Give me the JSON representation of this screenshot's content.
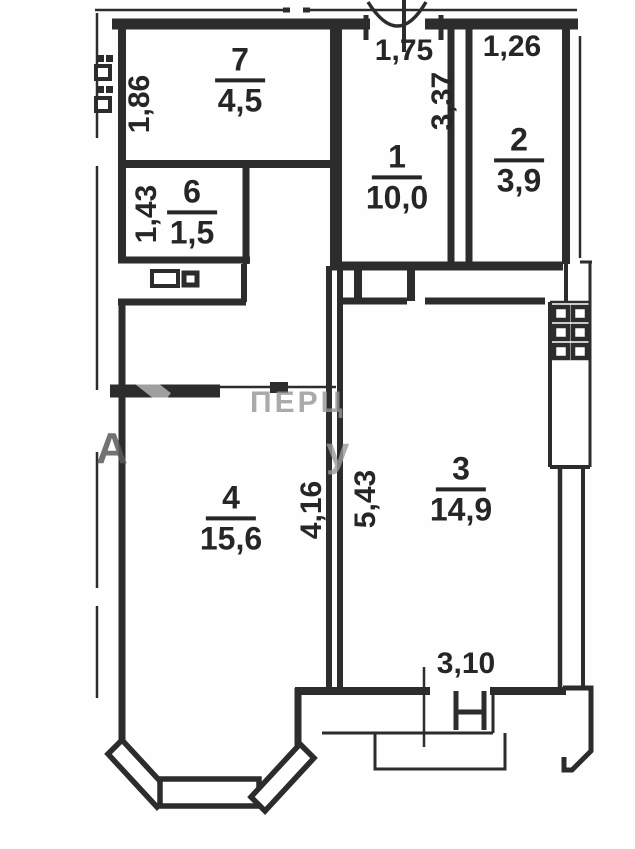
{
  "plan": {
    "title": "apartment-floor-plan",
    "rooms": [
      {
        "number": "7",
        "area": "4,5"
      },
      {
        "number": "6",
        "area": "1,5"
      },
      {
        "number": "1",
        "area": "10,0"
      },
      {
        "number": "2",
        "area": "3,9"
      },
      {
        "number": "4",
        "area": "15,6"
      },
      {
        "number": "3",
        "area": "14,9"
      }
    ],
    "dimensions": [
      {
        "value": "1,75"
      },
      {
        "value": "1,26"
      },
      {
        "value": "3,37"
      },
      {
        "value": "1,86"
      },
      {
        "value": "1,43"
      },
      {
        "value": "4,16"
      },
      {
        "value": "5,43"
      },
      {
        "value": "3,10"
      }
    ],
    "watermark": {
      "fragments": [
        "ПЕРЦ",
        "у",
        "А"
      ]
    },
    "colors": {
      "wall": "#2c2c2c",
      "background": "#fefefe",
      "watermark_gray": "#8f8f8f"
    }
  }
}
